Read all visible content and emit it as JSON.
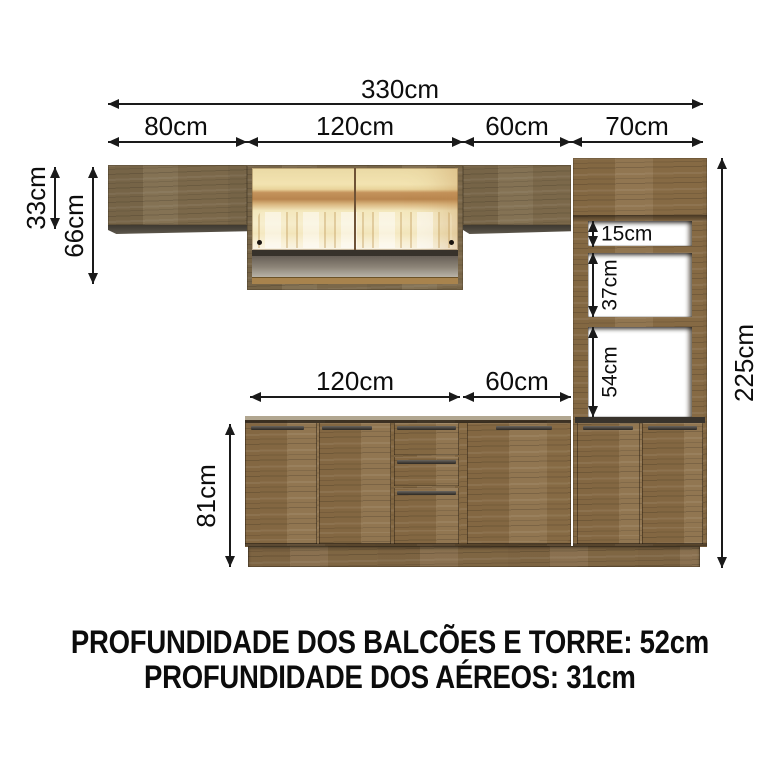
{
  "dims": {
    "total_width": {
      "label": "330cm"
    },
    "top_segments": [
      {
        "label": "80cm"
      },
      {
        "label": "120cm"
      },
      {
        "label": "60cm"
      },
      {
        "label": "70cm"
      }
    ],
    "aereo_small_height": {
      "label": "33cm"
    },
    "aereo_large_height": {
      "label": "66cm"
    },
    "total_height": {
      "label": "225cm"
    },
    "tower_niches": [
      {
        "label": "15cm"
      },
      {
        "label": "37cm"
      },
      {
        "label": "54cm"
      }
    ],
    "base_segments": [
      {
        "label": "120cm"
      },
      {
        "label": "60cm"
      }
    ],
    "base_height": {
      "label": "81cm"
    }
  },
  "footer": {
    "line1": "PROFUNDIDADE DOS BALCÕES E TORRE: 52cm",
    "line2": "PROFUNDIDADE DOS AÉREOS: 31cm"
  },
  "colors": {
    "wood_upper": "#7d6a4b",
    "wood_lower": "#8a6d46",
    "dim_line": "#1a1a1a",
    "glass_warm": "#f2e3ae",
    "glass_amber_band": "#b8854e",
    "niche_gray": "#bcb6ab",
    "background": "#ffffff"
  }
}
